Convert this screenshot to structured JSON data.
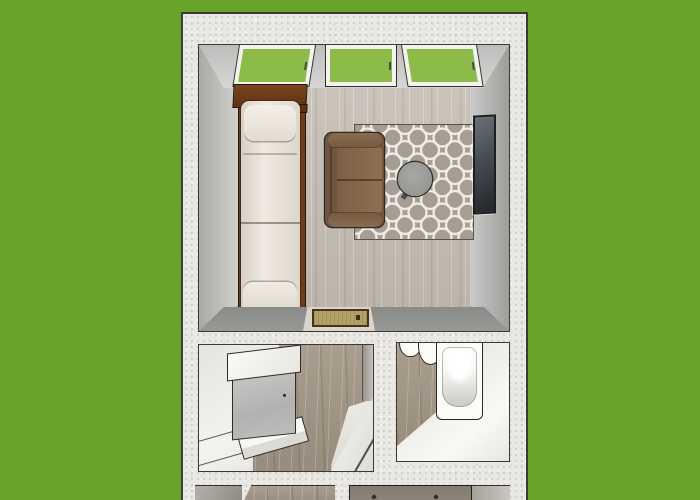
{
  "scene": {
    "description": "Top-down 3D rendering of a small apartment floor plan set on a green lawn background",
    "view": "top-down perspective render",
    "window_count": 3
  },
  "colors": {
    "grass": "#68a42b",
    "stucco": "#e9e8e4",
    "line": "#3a3a37",
    "glass": "#8cbb4a",
    "frameWhite": "#f2f2ef",
    "floorWood": "#c4bcb2",
    "hallWood": "#a39686",
    "darkWoodFloor": "#8f877b",
    "bedWood": "#6e3c18",
    "bedding": "#ebe5dc",
    "sofa": "#8e7052",
    "sofaDark": "#6d5540",
    "rugBase": "#a79d93",
    "rugPattern": "#efece6",
    "tableGray": "#8f8f8d",
    "artFrame": "#1c1f23",
    "artPanel": "#454b52",
    "mat": "#b2a167",
    "matBorder": "#4a3418",
    "fixtureWhite": "#fbfbf8",
    "cabinetGray": "#b2b2b0",
    "wallDarkBand": "#8e8e8c"
  },
  "rooms": [
    {
      "id": "living-room",
      "windows": 3,
      "furniture": [
        "bed",
        "sofa",
        "trellis-rug",
        "round-coffee-table",
        "wall-art",
        "door-mat"
      ]
    },
    {
      "id": "closet-room",
      "furniture": [
        "cabinet",
        "bench"
      ]
    },
    {
      "id": "bathroom",
      "furniture": [
        "toilet",
        "bathtub"
      ]
    },
    {
      "id": "hallway",
      "furniture": []
    },
    {
      "id": "bottom-room-partial",
      "furniture": [
        "dresser-with-knobs"
      ]
    }
  ]
}
